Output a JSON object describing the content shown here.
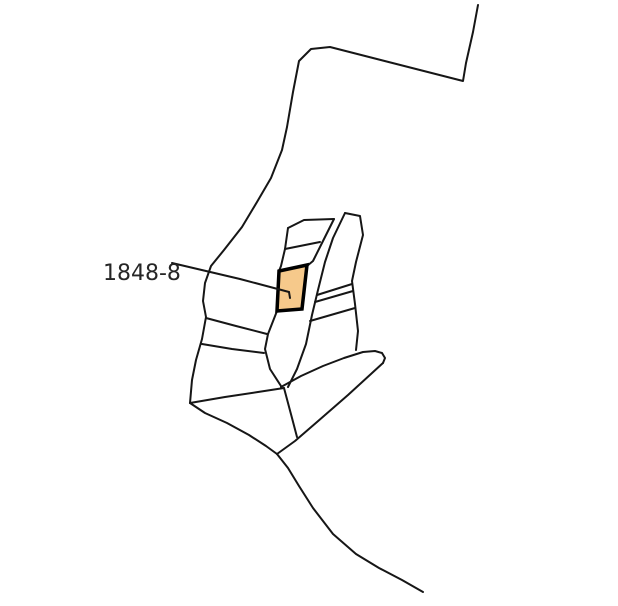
{
  "map": {
    "type": "cadastral-parcel-sketch",
    "background_color": "#ffffff",
    "line_color": "#161616",
    "line_width": 2,
    "label": {
      "text": "1848-8",
      "color": "#262626",
      "font_size": 22,
      "x": 103,
      "y": 280
    },
    "highlight_parcel": {
      "id": "1848-8",
      "fill": "#F6C98B",
      "stroke": "#000000",
      "stroke_width": 3.5,
      "points": [
        [
          279,
          271
        ],
        [
          307,
          265
        ],
        [
          302,
          309
        ],
        [
          277,
          311
        ]
      ]
    },
    "boundaries": [
      {
        "name": "outer-boundary-north-west",
        "points": [
          [
            478,
            5
          ],
          [
            473,
            32
          ],
          [
            466,
            63
          ],
          [
            463,
            81
          ],
          [
            330,
            47
          ],
          [
            311,
            49
          ],
          [
            299,
            61
          ],
          [
            293,
            92
          ],
          [
            287,
            127
          ],
          [
            282,
            150
          ],
          [
            271,
            178
          ],
          [
            257,
            202
          ],
          [
            242,
            227
          ],
          [
            224,
            250
          ],
          [
            211,
            266
          ],
          [
            205,
            283
          ],
          [
            203,
            301
          ],
          [
            206,
            317
          ],
          [
            202,
            339
          ],
          [
            196,
            360
          ],
          [
            192,
            380
          ],
          [
            190,
            403
          ]
        ]
      },
      {
        "name": "west-divider-upper",
        "points": [
          [
            206,
            318
          ],
          [
            236,
            326
          ],
          [
            267,
            334
          ]
        ]
      },
      {
        "name": "west-divider-lower",
        "points": [
          [
            202,
            344
          ],
          [
            232,
            349
          ],
          [
            264,
            353
          ]
        ]
      },
      {
        "name": "road-strip-left-upper",
        "points": [
          [
            334,
            219
          ],
          [
            322,
            243
          ],
          [
            313,
            261
          ],
          [
            307,
            266
          ]
        ]
      },
      {
        "name": "road-strip-left-lower",
        "points": [
          [
            277,
            311
          ],
          [
            268,
            334
          ],
          [
            265,
            349
          ],
          [
            270,
            369
          ],
          [
            281,
            386
          ]
        ]
      },
      {
        "name": "road-strip-right",
        "points": [
          [
            345,
            213
          ],
          [
            333,
            238
          ],
          [
            325,
            262
          ],
          [
            318,
            290
          ],
          [
            312,
            315
          ],
          [
            306,
            344
          ],
          [
            297,
            369
          ],
          [
            288,
            387
          ]
        ]
      },
      {
        "name": "north-stack-top-edge",
        "points": [
          [
            288,
            228
          ],
          [
            304,
            220
          ],
          [
            334,
            219
          ]
        ]
      },
      {
        "name": "north-stack-left-edge",
        "points": [
          [
            288,
            228
          ],
          [
            285,
            249
          ],
          [
            281,
            266
          ],
          [
            279,
            271
          ]
        ]
      },
      {
        "name": "north-stack-divider",
        "points": [
          [
            285,
            249
          ],
          [
            320,
            242
          ]
        ]
      },
      {
        "name": "east-parcel-boundary",
        "points": [
          [
            345,
            213
          ],
          [
            360,
            216
          ],
          [
            363,
            235
          ],
          [
            356,
            262
          ],
          [
            352,
            281
          ],
          [
            355,
            304
          ],
          [
            358,
            331
          ],
          [
            356,
            350
          ]
        ]
      },
      {
        "name": "east-divider-a",
        "points": [
          [
            317,
            295
          ],
          [
            352,
            284
          ]
        ]
      },
      {
        "name": "east-divider-b",
        "points": [
          [
            315,
            302
          ],
          [
            353,
            291
          ]
        ]
      },
      {
        "name": "east-divider-c",
        "points": [
          [
            310,
            321
          ],
          [
            355,
            308
          ]
        ]
      },
      {
        "name": "southeast-parcel-top-edge",
        "points": [
          [
            281,
            387
          ],
          [
            301,
            376
          ],
          [
            323,
            366
          ],
          [
            344,
            358
          ],
          [
            363,
            352
          ],
          [
            375,
            351
          ],
          [
            382,
            353
          ],
          [
            385,
            358
          ],
          [
            383,
            363
          ]
        ]
      },
      {
        "name": "southeast-parcel-diagonal",
        "points": [
          [
            383,
            363
          ],
          [
            348,
            395
          ],
          [
            317,
            422
          ],
          [
            295,
            441
          ],
          [
            277,
            454
          ]
        ]
      },
      {
        "name": "south-cross-line",
        "points": [
          [
            190,
            403
          ],
          [
            225,
            397
          ],
          [
            258,
            392
          ],
          [
            284,
            388
          ]
        ]
      },
      {
        "name": "southwest-curve",
        "points": [
          [
            190,
            403
          ],
          [
            205,
            413
          ],
          [
            227,
            423
          ],
          [
            249,
            435
          ],
          [
            266,
            446
          ],
          [
            277,
            454
          ]
        ]
      },
      {
        "name": "road-neck",
        "points": [
          [
            284,
            388
          ],
          [
            292,
            418
          ],
          [
            297,
            437
          ]
        ]
      },
      {
        "name": "south-tail-curve",
        "points": [
          [
            277,
            454
          ],
          [
            288,
            468
          ],
          [
            299,
            486
          ],
          [
            313,
            508
          ],
          [
            333,
            534
          ],
          [
            356,
            554
          ],
          [
            379,
            568
          ],
          [
            402,
            580
          ],
          [
            423,
            592
          ]
        ]
      }
    ],
    "annotations": [
      {
        "name": "label-leader-line",
        "points": [
          [
            172,
            263
          ],
          [
            240,
            279
          ],
          [
            289,
            292
          ]
        ]
      },
      {
        "name": "label-leader-hook",
        "points": [
          [
            289,
            292
          ],
          [
            290,
            298
          ]
        ]
      }
    ]
  }
}
